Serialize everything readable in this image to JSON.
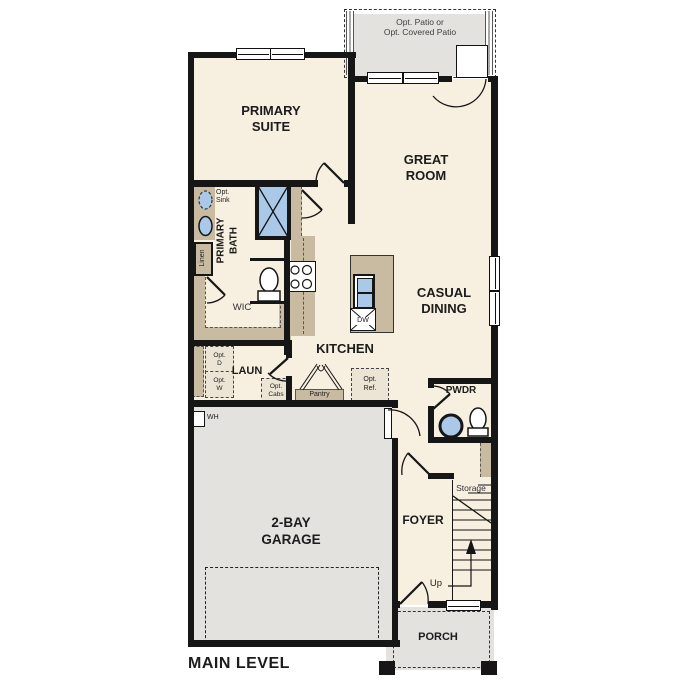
{
  "title": "MAIN LEVEL",
  "patio": {
    "line1": "Opt. Patio or",
    "line2": "Opt. Covered Patio"
  },
  "rooms": {
    "primary_suite": [
      "PRIMARY",
      "SUITE"
    ],
    "great_room": [
      "GREAT",
      "ROOM"
    ],
    "casual_dining": [
      "CASUAL",
      "DINING"
    ],
    "kitchen": "KITCHEN",
    "primary_bath": [
      "PRIMARY",
      "BATH"
    ],
    "wic": "WIC",
    "laundry": "LAUN",
    "garage": [
      "2-BAY",
      "GARAGE"
    ],
    "foyer": "FOYER",
    "pwdr": "PWDR",
    "storage": "Storage",
    "porch": "PORCH"
  },
  "annotations": {
    "opt_sink": [
      "Opt.",
      "Sink"
    ],
    "linen": "Linen",
    "opt_d": [
      "Opt.",
      "D"
    ],
    "opt_w": [
      "Opt.",
      "W"
    ],
    "opt_cabs": [
      "Opt.",
      "Cabs"
    ],
    "pantry": "Pantry",
    "opt_ref": [
      "Opt.",
      "Ref."
    ],
    "dw": "DW",
    "wh": "WH",
    "up": "Up"
  },
  "colors": {
    "wall": "#161616",
    "floor": "#f7efdf",
    "outdoor": "#e3e2df",
    "cabinet": "#c8bba1",
    "fixture_blue": "#aac9e9"
  }
}
